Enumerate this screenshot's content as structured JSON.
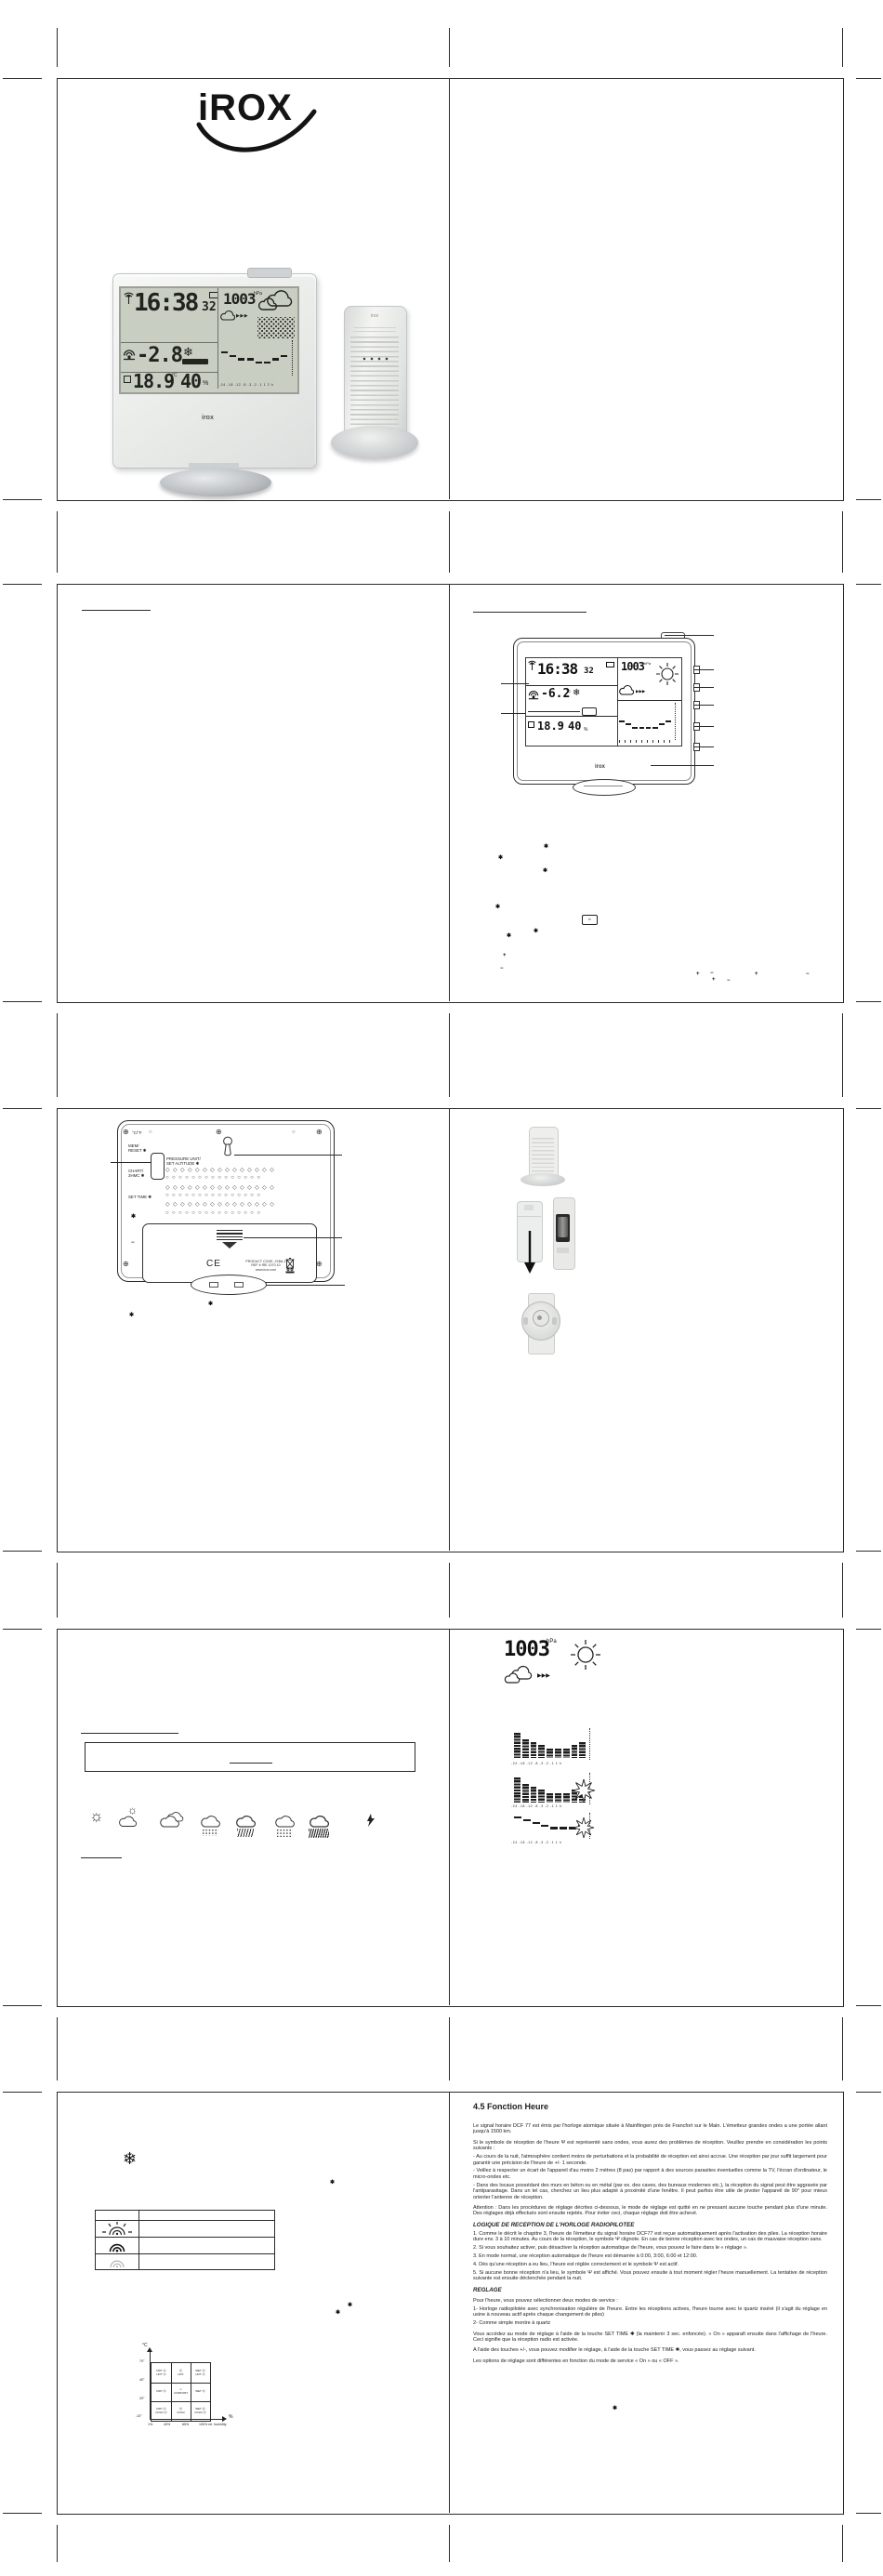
{
  "brand": {
    "logo_text": "iROX",
    "logo_small": "irox"
  },
  "station_lcd": {
    "time": "16:38",
    "seconds": "32",
    "pressure": "1003",
    "pressure_unit": "hPa",
    "outdoor_temp": "-2.8",
    "degree_unit": "°C",
    "snow_icon": "❄",
    "indoor_temp": "18.9",
    "indoor_humidity": "40",
    "percent": "%",
    "forecast_arrows": "▶▶▶",
    "history_values": [
      6,
      5,
      4,
      4,
      3,
      3,
      4,
      5
    ],
    "history_ticks": [
      "-24",
      "-18",
      "-12",
      "-8",
      "-3",
      "-2",
      "-1",
      "1",
      "2",
      "h"
    ]
  },
  "diagram_lcd": {
    "time": "16:38",
    "seconds": "32",
    "pressure": "1003",
    "pressure_unit": "hPa",
    "outdoor_temp": "-6.2",
    "degree_unit": "°C",
    "snow_icon": "❄",
    "indoor_temp": "18.9",
    "indoor_humidity": "40",
    "percent": "%",
    "forecast_arrows": "▶▶▶",
    "history_values": [
      5,
      4,
      3,
      3,
      3,
      3,
      4,
      5
    ]
  },
  "diagram_marks": [
    {
      "x": 585,
      "y": 908,
      "c": "✱"
    },
    {
      "x": 536,
      "y": 920,
      "c": "✱"
    },
    {
      "x": 584,
      "y": 934,
      "c": "✱"
    },
    {
      "x": 533,
      "y": 973,
      "c": "✱"
    },
    {
      "x": 574,
      "y": 999,
      "c": "✱"
    },
    {
      "x": 545,
      "y": 1004,
      "c": "✱"
    },
    {
      "x": 541,
      "y": 1025,
      "c": "+"
    },
    {
      "x": 538,
      "y": 1039,
      "c": "−"
    },
    {
      "x": 749,
      "y": 1045,
      "c": "+"
    },
    {
      "x": 764,
      "y": 1044,
      "c": "−"
    },
    {
      "x": 766,
      "y": 1051,
      "c": "+"
    },
    {
      "x": 782,
      "y": 1052,
      "c": "−"
    },
    {
      "x": 812,
      "y": 1045,
      "c": "+"
    },
    {
      "x": 867,
      "y": 1045,
      "c": "−"
    }
  ],
  "back_panel": {
    "label_cf": "°C/°F",
    "label_mem": [
      "MEM/",
      "RESET ✱"
    ],
    "label_pressure": [
      "PRESSURE UNIT/",
      "SET ALTITUDE ✱"
    ],
    "label_chart": [
      "CHART/",
      "3HMC ✱"
    ],
    "label_settime": "SET TIME ✱",
    "ce_mark": "CE",
    "product_lines": [
      "PRODUCT CODE: JXBA-1",
      "REF # IRE 1070.10",
      "www.irox.com"
    ],
    "speaker_rows": 6,
    "speaker_cols": 15
  },
  "back_marks": [
    {
      "x": 141,
      "y": 1306,
      "c": "✱"
    },
    {
      "x": 141,
      "y": 1334,
      "c": "−"
    },
    {
      "x": 224,
      "y": 1400,
      "c": "✱"
    },
    {
      "x": 139,
      "y": 1412,
      "c": "✱"
    }
  ],
  "weather_icons": [
    "sun",
    "sun-cloud",
    "clouds",
    "rain-light",
    "rain-heavy",
    "snow",
    "rain-downpour",
    "lightning"
  ],
  "pressure_panel": {
    "pressure": "1003",
    "unit": "hPa",
    "arrows": "▶▶▶",
    "hist1": {
      "values": [
        8,
        6,
        5,
        4,
        3,
        3,
        3,
        4,
        5
      ],
      "ticks": [
        "-24",
        "-18",
        "-12",
        "-8",
        "-3",
        "-2",
        "-1",
        "1",
        "h"
      ]
    },
    "hist2": {
      "values": [
        8,
        6,
        5,
        4,
        3,
        3,
        3,
        4,
        5
      ],
      "ticks": [
        "-24",
        "-18",
        "-12",
        "-8",
        "-3",
        "-2",
        "-1",
        "1",
        "h"
      ],
      "sunburst": true
    },
    "steps": {
      "values": [
        7,
        6,
        5,
        4,
        3,
        3,
        3,
        4
      ],
      "ticks": [
        "-24",
        "-18",
        "-12",
        "-8",
        "-3",
        "-2",
        "-1",
        "1",
        "h"
      ],
      "sunburst": true
    }
  },
  "comfort_chart": {
    "y_axis": "°C",
    "x_axis": "%",
    "x_caption": "100% rel. humidity",
    "y_ticks": [
      "70°",
      "40°",
      "20°",
      "-10°"
    ],
    "x_ticks": [
      "1%",
      "40%",
      "65%"
    ],
    "cells": [
      [
        "DRY ☹",
        "HOT ☹"
      ],
      [
        "☹",
        "HOT"
      ],
      [
        "WET ☹",
        "HOT ☹"
      ],
      [
        "DRY ☹"
      ],
      [
        "☺",
        "COMFORT"
      ],
      [
        "WET ☹"
      ],
      [
        "DRY ☹",
        "COLD ☹"
      ],
      [
        "☹",
        "COLD"
      ],
      [
        "WET ☹",
        "COLD ☹"
      ]
    ]
  },
  "section5_marks": [
    {
      "x": 355,
      "y": 2345,
      "c": "✱"
    },
    {
      "x": 374,
      "y": 2477,
      "c": "✱"
    },
    {
      "x": 361,
      "y": 2485,
      "c": "✱"
    },
    {
      "x": 659,
      "y": 2588,
      "c": "✱"
    }
  ],
  "snowflake": "❄",
  "time_function": {
    "title": "4.5 Fonction Heure",
    "blocks": [
      {
        "t": "p",
        "text": "Le signal horaire DCF 77 est émis par l'horloge atomique située à Mainflingen près de Francfort sur le Main. L'émetteur grandes ondes a une portée allant jusqu'à 1500 km."
      },
      {
        "t": "p",
        "text": "Si le symbole de réception de l'heure Ψ est représenté sans ondes, vous aurez des problèmes de réception. Veuillez prendre en considération les points suivants :"
      },
      {
        "t": "l",
        "text": "- Au cours de la nuit, l'atmosphère contient moins de perturbations et la probabilité de réception est ainsi accrue. Une réception par jour suffit largement pour garantir une précision de l'heure de +/- 1 seconde."
      },
      {
        "t": "l",
        "text": "- Veillez à respecter un écart de l'appareil d'au moins 2 mètres (8 pas) par rapport à des sources parasites éventuelles comme la TV, l'écran d'ordinateur, le micro-ondes etc."
      },
      {
        "t": "l",
        "text": "- Dans des locaux possédant des murs en béton ou en métal (par ex. des caves, des bureaux modernes etc.), la réception du signal peut être aggravée par l'antiparasitage. Dans un tel cas, cherchez un lieu plus adapté à proximité d'une fenêtre. Il peut parfois être utile de pivoter l'appareil de 90° pour mieux orienter l'antenne de réception."
      },
      {
        "t": "p",
        "text": "Attention : Dans les procédures de réglage décrites ci-dessous, le mode de réglage est quitté en ne pressant aucune touche pendant plus d'une minute. Des réglages déjà effectués sont ensuite rejetés. Pour éviter ceci, chaque réglage doit être achevé."
      },
      {
        "t": "h",
        "text": "LOGIQUE DE RECEPTION DE L'HORLOGE RADIOPILOTEE"
      },
      {
        "t": "l",
        "text": "1. Comme le décrit le chapitre 3, l'heure de l'émetteur du signal horaire DCF77 est reçue automatiquement après l'activation des piles. La réception horaire dure env. 3 à 10 minutes. Au cours de la réception, le symbole Ψ clignote. En cas de bonne réception avec les ondes, un cas de mauvaise réception sans."
      },
      {
        "t": "l",
        "text": "2. Si vous souhaitez activer, puis désactiver la réception automatique de l'heure, vous pouvez le faire dans le « réglage »."
      },
      {
        "t": "l",
        "text": "3. En mode normal, une réception automatique de l'heure est démarrée à 0:00, 3:00, 6:00 et 12:00."
      },
      {
        "t": "l",
        "text": "4. Dès qu'une réception a eu lieu, l'heure est réglée correctement et le symbole Ψ est actif."
      },
      {
        "t": "l",
        "text": "5. Si aucune bonne réception n'a lieu, le symbole Ψ est affiché. Vous pouvez ensuite à tout moment régler l'heure manuellement. La tentative de réception suivante est ensuite déclenchée pendant la nuit."
      },
      {
        "t": "h",
        "text": "REGLAGE"
      },
      {
        "t": "p",
        "text": "Pour l'heure, vous pouvez sélectionner deux modes de service :"
      },
      {
        "t": "l",
        "text": "1- Horloge radiopilotée avec synchronisation régulière de l'heure. Entre les réceptions actives, l'heure tourne avec le quartz inséré (il s'agit du réglage en usine à nouveau actif après chaque changement de piles)"
      },
      {
        "t": "l",
        "text": "2- Comme simple montre à quartz"
      },
      {
        "t": "p",
        "text": "Vous accédez au mode de réglage à l'aide de la touche SET TIME ✱ (la maintenir 3 sec. enfoncée). « On » apparaît ensuite dans l'affichage de l'heure. Ceci signifie que la réception radio est activée."
      },
      {
        "t": "p",
        "text": "A l'aide des touches +/-, vous pouvez modifier le réglage, à l'aide de la touche SET TIME ✱, vous passez au réglage suivant."
      },
      {
        "t": "p",
        "text": "Les options de réglage sont différentes en fonction du mode de service « On » ou « OFF »."
      }
    ]
  }
}
